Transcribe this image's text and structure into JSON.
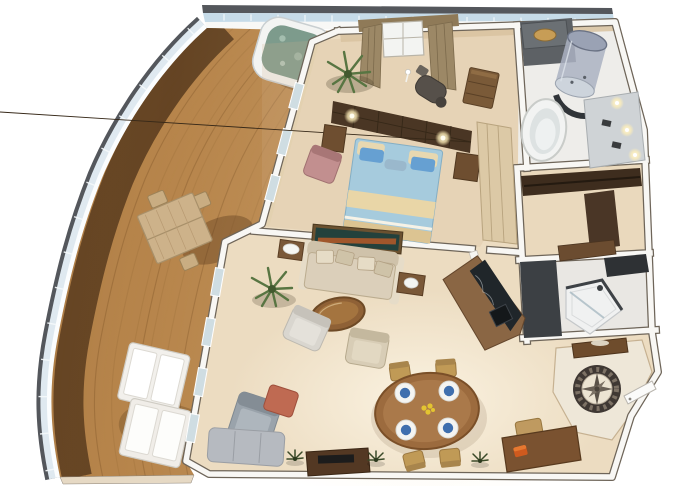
{
  "scene": {
    "type": "3d-floor-plan",
    "subject": "luxury suite with curved wraparound teak veranda",
    "background": "#ffffff"
  },
  "colors": {
    "deck_wood": "#b5834a",
    "deck_shadow": "#55371b",
    "rail_frame": "#54575c",
    "rail_glass": "#dfe9f0",
    "floor_beige": "#ecdcc1",
    "wall_white": "#f8f7f4",
    "wall_edge": "#6e6559",
    "bath_floor": "#eeedea",
    "bed_duvet": "#a6cbdd",
    "bed_trim": "#e9d6a7",
    "pillow_blue": "#66a0d2",
    "tub_water": "#7d9b8c",
    "sofa_beige": "#dbcfba",
    "chair_gray": "#9aa3ab",
    "ottoman_coral": "#bf6a52",
    "plant_green": "#587542",
    "granite_black": "#20262a",
    "table_wood": "#9c6b3e",
    "medallion_dark": "#3f3833",
    "medallion_cream": "#ece4d2",
    "plate_blue": "#3f6fae",
    "flower_yellow": "#e3c431",
    "wood_dark": "#4a3624",
    "curtain_brown": "#9c8866"
  },
  "rooms": [
    {
      "name": "veranda",
      "furniture": [
        "whirlpool-hot-tub",
        "teak-dining-table",
        "deck-chairs",
        "sun-loungers",
        "glass-railing",
        "teak-deck-planks"
      ]
    },
    {
      "name": "sitting-nook",
      "furniture": [
        "window",
        "curtains",
        "massage-chair",
        "crane-statue",
        "drawer-chest",
        "palm-plant"
      ]
    },
    {
      "name": "bedroom",
      "furniture": [
        "king-bed",
        "headboard-wall",
        "reading-lamps",
        "nightstands",
        "accent-armchair",
        "wardrobe-sliding-doors"
      ]
    },
    {
      "name": "master-bathroom",
      "furniture": [
        "round-bathtub",
        "cylindrical-glass-shower",
        "counter-with-basin",
        "vanity",
        "mirror-lights"
      ]
    },
    {
      "name": "walk-in-closet",
      "furniture": [
        "wardrobe-unit",
        "bench"
      ]
    },
    {
      "name": "guest-bathroom",
      "furniture": [
        "corner-shower",
        "dark-counter"
      ]
    },
    {
      "name": "living-room",
      "furniture": [
        "sofa",
        "wall-painting",
        "side-tables",
        "round-coffee-table",
        "armchair-light",
        "armchair-beige",
        "lounge-chair",
        "coral-ottoman",
        "corner-sofa",
        "tv-console",
        "bar-cabinet-granite",
        "palm-plant",
        "floor-plants"
      ]
    },
    {
      "name": "dining-area",
      "furniture": [
        "oval-dining-table",
        "dining-chairs-x4",
        "place-settings-x4",
        "flower-centerpiece"
      ]
    },
    {
      "name": "study-corner",
      "furniture": [
        "writing-desk",
        "desk-chair",
        "orange-bag"
      ]
    },
    {
      "name": "foyer",
      "furniture": [
        "compass-rose-floor-medallion",
        "console-table",
        "entry-door"
      ]
    }
  ],
  "counts": {
    "dining_seats": 4,
    "place_settings": 4,
    "sun_loungers": 2
  }
}
